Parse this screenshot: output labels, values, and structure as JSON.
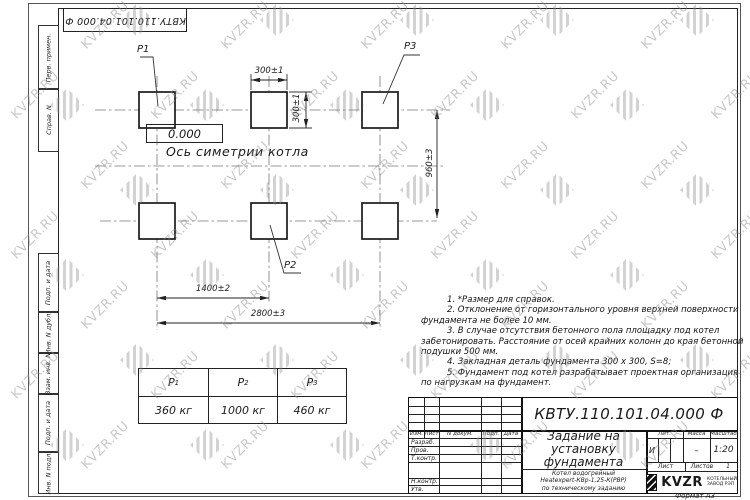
{
  "watermark": {
    "text": "KVZR.RU"
  },
  "frame": {
    "top_stamp": "КВТУ.110.101.04.000  Ф",
    "format_note": "Формат А3",
    "margin_labels": [
      "Перв. примен.",
      "Справ. N",
      "Подп. и дата",
      "Инв. N дубл.",
      "Взам. инв. N",
      "Подп. и дата",
      "Инв. N подл."
    ]
  },
  "drawing": {
    "pad_labels": {
      "p1": "P1",
      "p2": "P2",
      "p3": "P3"
    },
    "elevation": "0.000",
    "axis_label": "Ось симетрии котла",
    "dimensions": {
      "pad_width": "300±1",
      "pad_height": "300±1",
      "row_spacing": "960±3",
      "col_spacing_inner": "1400±2",
      "col_spacing_outer": "2800±3"
    }
  },
  "load_table": {
    "columns": [
      {
        "name": "P",
        "sub": "1",
        "value": "360 кг"
      },
      {
        "name": "P",
        "sub": "2",
        "value": "1000 кг"
      },
      {
        "name": "P",
        "sub": "3",
        "value": "460 кг"
      }
    ]
  },
  "notes": {
    "lines": [
      "1. *Размер для справок.",
      "2. Отклонение от горизонтального уровня верхней поверхности",
      "фундамента не более 10 мм.",
      "3. В случае отсутствия бетонного пола площадку под котел",
      "забетонировать. Расстояние от осей крайних колонн до края бетонной",
      "подушки 500 мм.",
      "4. Закладная деталь фундамента  300 х 300, S=8;",
      "5. Фундамент под котел разрабатывает проектная организация",
      "по нагрузкам на фундамент."
    ]
  },
  "title_block": {
    "doc_number": "КВТУ.110.101.04.000  Ф",
    "title_lines": [
      "Задание на",
      "установку",
      "фундамента"
    ],
    "product_lines": [
      "Котел водогрейный",
      "Heatexpert-КВр-1,25-К(РВР)",
      "по техническому заданию"
    ],
    "columns": {
      "izm": "Изм.",
      "list": "Лист",
      "doc": "N докум.",
      "podp": "Подп.",
      "data": "Дата"
    },
    "signature_rows": {
      "razrab": "Разраб.",
      "prov": "Пров.",
      "t_kontr": "Т.контр.",
      "n_kontr": "Н.контр.",
      "utv": "Утв."
    },
    "lit": {
      "label": "Лит.",
      "value": "И"
    },
    "massa": {
      "label": "Масса",
      "value": "–"
    },
    "masshtab": {
      "label": "Масштаб",
      "value": "1:20"
    },
    "sheet": {
      "list_label": "Лист",
      "listov_label": "Листов",
      "listov_value": "1"
    },
    "logo": {
      "name": "KVZR",
      "line1": "КОТЕЛЬНЫЙ",
      "line2": "ЗАВОД РЭП"
    }
  }
}
